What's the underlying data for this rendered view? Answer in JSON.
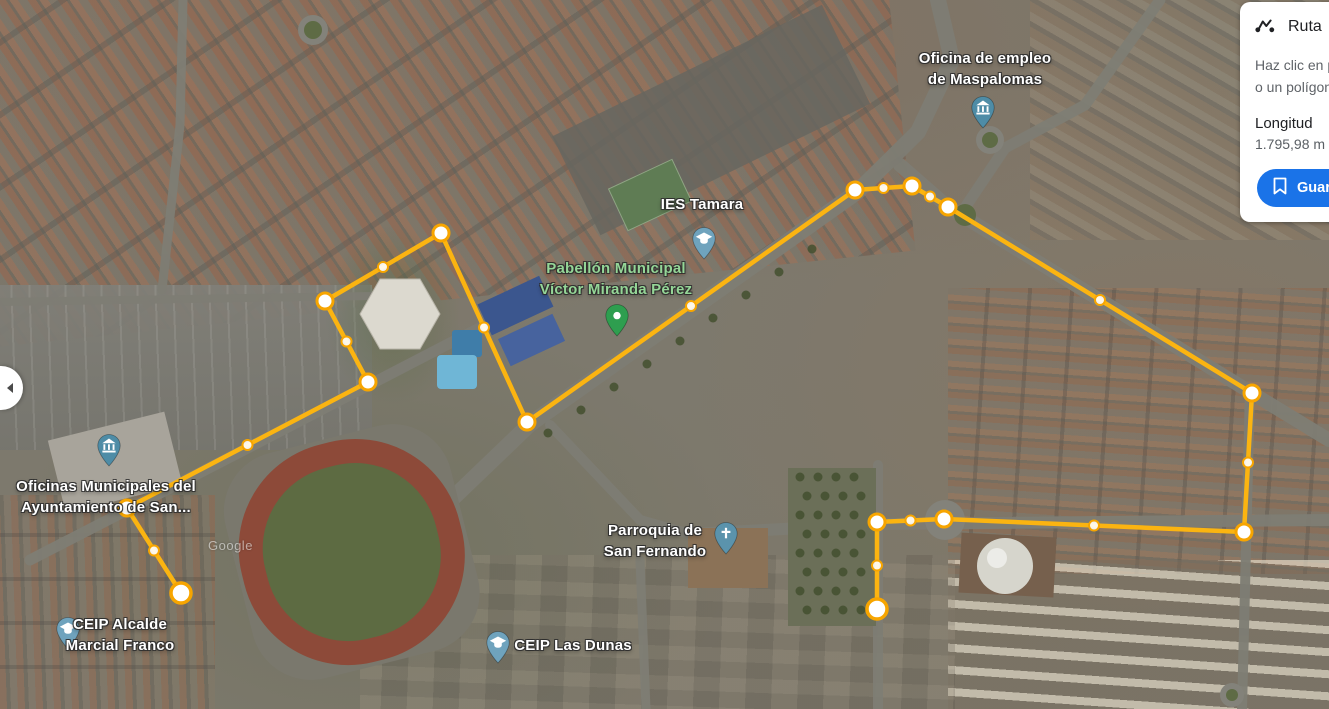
{
  "panel": {
    "title": "Ruta",
    "help_line1": "Haz clic en p",
    "help_line2": "o un polígon",
    "length_label": "Longitud",
    "length_value": "1.795,98 m",
    "save_label": "Guardar",
    "accent_color": "#1a73e8"
  },
  "map": {
    "watermark": "Google",
    "labels": [
      {
        "id": "oficina-empleo",
        "lines": [
          "Oficina de empleo",
          "de Maspalomas"
        ],
        "pin": "institution"
      },
      {
        "id": "ies-tamara",
        "lines": [
          "IES Tamara"
        ],
        "pin": "school"
      },
      {
        "id": "pabellon-municipal",
        "lines": [
          "Pabellón Municipal",
          "Víctor Miranda Pérez"
        ],
        "pin": "green-poi"
      },
      {
        "id": "oficinas-municipales",
        "lines": [
          "Oficinas Municipales del",
          "Ayuntamiento de San..."
        ],
        "pin": "institution"
      },
      {
        "id": "ceip-alcalde",
        "lines": [
          "CEIP Alcalde",
          "Marcial Franco"
        ],
        "pin": "school"
      },
      {
        "id": "parroquia",
        "lines": [
          "Parroquia de",
          "San Fernando"
        ],
        "pin": "church"
      },
      {
        "id": "ceip-las-dunas",
        "lines": [
          "CEIP Las Dunas"
        ],
        "pin": "school"
      }
    ],
    "route": {
      "line_color": "#FBB411",
      "ring_color": "#F7A500",
      "vertices": [
        [
          181,
          593
        ],
        [
          127,
          508
        ],
        [
          368,
          382
        ],
        [
          325,
          301
        ],
        [
          441,
          233
        ],
        [
          527,
          422
        ],
        [
          855,
          190
        ],
        [
          912,
          186
        ],
        [
          948,
          207
        ],
        [
          1252,
          393
        ],
        [
          1244,
          532
        ],
        [
          944,
          519
        ],
        [
          877,
          522
        ],
        [
          877,
          609
        ]
      ]
    }
  }
}
